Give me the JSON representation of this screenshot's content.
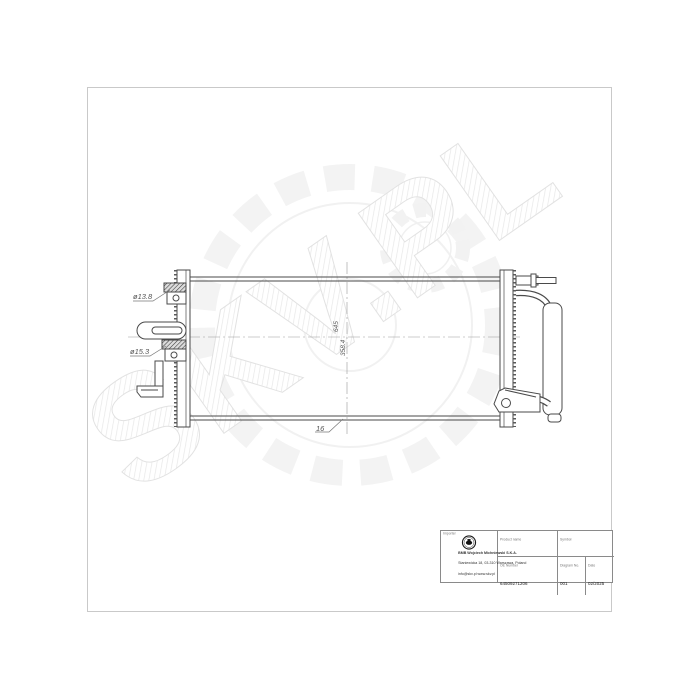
{
  "watermark": {
    "text": "SKV.PL"
  },
  "drawing": {
    "dims": {
      "port_top": "ø13.8",
      "port_bottom": "ø15.3",
      "core_width": "645",
      "core_height": "358.4",
      "core_depth": "16"
    }
  },
  "title_block": {
    "producer": {
      "label": "Importer",
      "company": "BMB Wojciech Michniewski S.K.A.",
      "address": "Staniewicka 18, 03-310 Warszawa, Poland",
      "contact": "info@skv.pl  www.skv.pl"
    },
    "product": {
      "label": "Product name",
      "value": "AIR CONDITIONING CONDENSER"
    },
    "symbol": {
      "label": "Symbol",
      "value": "86SKV287"
    },
    "oe": {
      "label": "OE Number",
      "value": "64509271206"
    },
    "diagram": {
      "label": "Diagram No.",
      "value": "001"
    },
    "date": {
      "label": "Date",
      "value": "02/2025"
    }
  }
}
